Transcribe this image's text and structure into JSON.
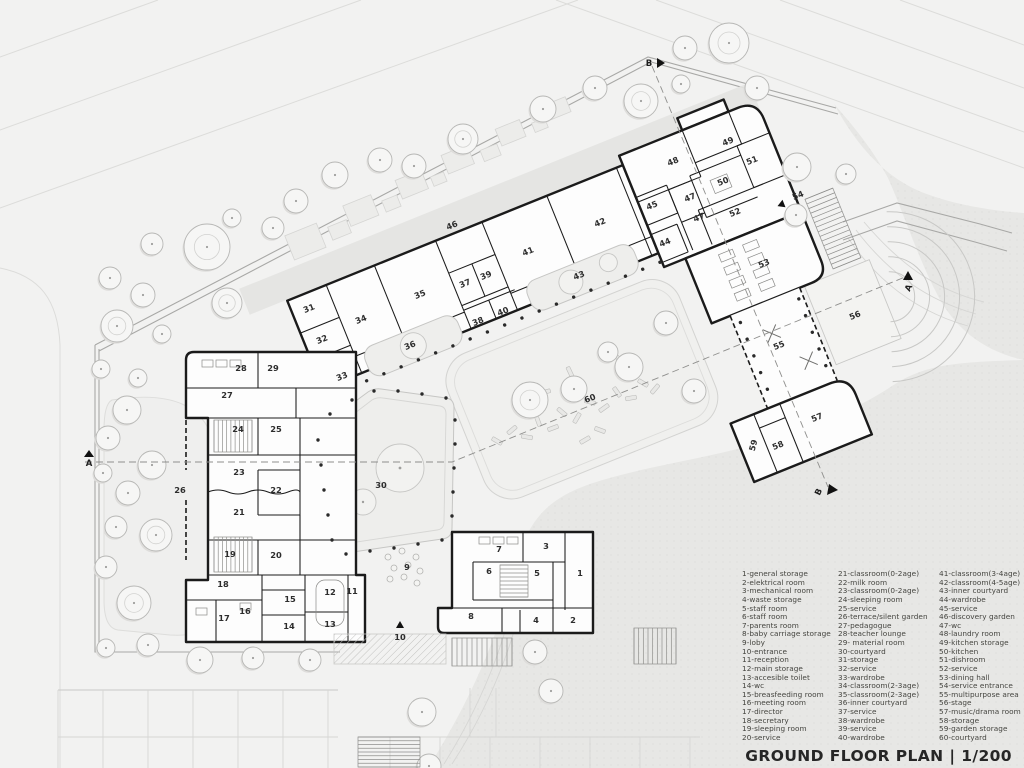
{
  "header": {
    "title": "GROUND FLOOR PLAN | 1/200"
  },
  "legend": {
    "columns": [
      [
        "1-general storage",
        "2-elektrical room",
        "3-mechanical room",
        "4-waste storage",
        "5-staff room",
        "6-staff room",
        "7-parents room",
        "8-baby carriage storage",
        "9-loby",
        "10-entrance",
        "11-reception",
        "12-main storage",
        "13-accesible toilet",
        "14-wc",
        "15-breasfeeding room",
        "16-meeting room",
        "17-director",
        "18-secretary",
        "19-sleeping room",
        "20-service"
      ],
      [
        "21-classroom(0-2age)",
        "22-milk room",
        "23-classroom(0-2age)",
        "24-sleeping room",
        "25-service",
        "26-terrace/silent garden",
        "27-pedagogue",
        "28-teacher lounge",
        "29- material room",
        "30-courtyard",
        "31-storage",
        "32-service",
        "33-wardrobe",
        "34-classroom(2-3age)",
        "35-classroom(2-3age)",
        "36-inner courtyard",
        "37-service",
        "38-wardrobe",
        "39-service",
        "40-wardrobe"
      ],
      [
        "41-classroom(3-4age)",
        "42-classroom(4-5age)",
        "43-inner courtyard",
        "44-wardrobe",
        "45-service",
        "46-discovery garden",
        "47-wc",
        "48-laundry room",
        "49-kitchen storage",
        "50-kitchen",
        "51-dishroom",
        "52-service",
        "53-dining hall",
        "54-service entrance",
        "55-multipurpose area",
        "56-stage",
        "57-music/drama room",
        "58-storage",
        "59-garden storage",
        "60-courtyard"
      ]
    ]
  },
  "plan": {
    "rooms": [
      {
        "n": "1",
        "x": 580,
        "y": 576,
        "rot": 0
      },
      {
        "n": "2",
        "x": 573,
        "y": 623,
        "rot": 0
      },
      {
        "n": "3",
        "x": 546,
        "y": 549,
        "rot": 0
      },
      {
        "n": "4",
        "x": 536,
        "y": 623,
        "rot": 0
      },
      {
        "n": "5",
        "x": 537,
        "y": 576,
        "rot": 0
      },
      {
        "n": "6",
        "x": 489,
        "y": 574,
        "rot": 0
      },
      {
        "n": "7",
        "x": 499,
        "y": 552,
        "rot": 0
      },
      {
        "n": "8",
        "x": 471,
        "y": 619,
        "rot": 0
      },
      {
        "n": "9",
        "x": 407,
        "y": 570,
        "rot": 0
      },
      {
        "n": "10",
        "x": 400,
        "y": 640,
        "rot": 0
      },
      {
        "n": "11",
        "x": 352,
        "y": 594,
        "rot": 0
      },
      {
        "n": "12",
        "x": 330,
        "y": 595,
        "rot": 0
      },
      {
        "n": "13",
        "x": 330,
        "y": 627,
        "rot": 0
      },
      {
        "n": "14",
        "x": 289,
        "y": 629,
        "rot": 0
      },
      {
        "n": "15",
        "x": 290,
        "y": 602,
        "rot": 0
      },
      {
        "n": "16",
        "x": 245,
        "y": 614,
        "rot": 0
      },
      {
        "n": "17",
        "x": 224,
        "y": 621,
        "rot": 0
      },
      {
        "n": "18",
        "x": 223,
        "y": 587,
        "rot": 0
      },
      {
        "n": "19",
        "x": 230,
        "y": 557,
        "rot": 0
      },
      {
        "n": "20",
        "x": 276,
        "y": 558,
        "rot": 0
      },
      {
        "n": "21",
        "x": 239,
        "y": 515,
        "rot": 0
      },
      {
        "n": "22",
        "x": 276,
        "y": 493,
        "rot": 0
      },
      {
        "n": "23",
        "x": 239,
        "y": 475,
        "rot": 0
      },
      {
        "n": "24",
        "x": 238,
        "y": 432,
        "rot": 0
      },
      {
        "n": "25",
        "x": 276,
        "y": 432,
        "rot": 0
      },
      {
        "n": "26",
        "x": 180,
        "y": 493,
        "rot": 0
      },
      {
        "n": "27",
        "x": 227,
        "y": 398,
        "rot": 0
      },
      {
        "n": "28",
        "x": 241,
        "y": 371,
        "rot": 0
      },
      {
        "n": "29",
        "x": 273,
        "y": 371,
        "rot": 0
      },
      {
        "n": "30",
        "x": 381,
        "y": 488,
        "rot": 0
      },
      {
        "n": "31",
        "x": 310,
        "y": 311,
        "rot": -22
      },
      {
        "n": "32",
        "x": 323,
        "y": 342,
        "rot": -22
      },
      {
        "n": "33",
        "x": 343,
        "y": 379,
        "rot": -22
      },
      {
        "n": "34",
        "x": 362,
        "y": 322,
        "rot": -22
      },
      {
        "n": "35",
        "x": 421,
        "y": 297,
        "rot": -22
      },
      {
        "n": "36",
        "x": 411,
        "y": 348,
        "rot": -22
      },
      {
        "n": "37",
        "x": 466,
        "y": 286,
        "rot": -22
      },
      {
        "n": "38",
        "x": 479,
        "y": 324,
        "rot": -22
      },
      {
        "n": "39",
        "x": 487,
        "y": 278,
        "rot": -22
      },
      {
        "n": "40",
        "x": 504,
        "y": 314,
        "rot": -22
      },
      {
        "n": "41",
        "x": 529,
        "y": 254,
        "rot": -22
      },
      {
        "n": "42",
        "x": 601,
        "y": 225,
        "rot": -22
      },
      {
        "n": "43",
        "x": 580,
        "y": 278,
        "rot": -22
      },
      {
        "n": "44",
        "x": 666,
        "y": 245,
        "rot": -22
      },
      {
        "n": "45",
        "x": 653,
        "y": 208,
        "rot": -22
      },
      {
        "n": "46",
        "x": 453,
        "y": 228,
        "rot": -22
      },
      {
        "n": "47",
        "x": 691,
        "y": 200,
        "rot": -22
      },
      {
        "n": "47",
        "x": 700,
        "y": 220,
        "rot": -22
      },
      {
        "n": "48",
        "x": 674,
        "y": 164,
        "rot": -22
      },
      {
        "n": "49",
        "x": 729,
        "y": 144,
        "rot": -22
      },
      {
        "n": "50",
        "x": 724,
        "y": 184,
        "rot": -22
      },
      {
        "n": "51",
        "x": 753,
        "y": 163,
        "rot": -22
      },
      {
        "n": "52",
        "x": 736,
        "y": 215,
        "rot": -22
      },
      {
        "n": "53",
        "x": 765,
        "y": 266,
        "rot": -22
      },
      {
        "n": "54",
        "x": 799,
        "y": 198,
        "rot": -22
      },
      {
        "n": "55",
        "x": 780,
        "y": 348,
        "rot": -22
      },
      {
        "n": "56",
        "x": 856,
        "y": 318,
        "rot": -22
      },
      {
        "n": "57",
        "x": 818,
        "y": 420,
        "rot": -22
      },
      {
        "n": "58",
        "x": 779,
        "y": 448,
        "rot": -22
      },
      {
        "n": "59",
        "x": 756,
        "y": 446,
        "rot": -75
      },
      {
        "n": "60",
        "x": 591,
        "y": 401,
        "rot": -22
      }
    ],
    "section_markers": [
      {
        "label": "A",
        "x": 89,
        "y": 466,
        "rot": 0,
        "tri": [
          89,
          450,
          84,
          457,
          94,
          457
        ]
      },
      {
        "label": "A",
        "x": 911,
        "y": 289,
        "rot": -65,
        "tri": [
          908,
          271,
          903,
          280,
          913,
          280
        ]
      },
      {
        "label": "B",
        "x": 649,
        "y": 66,
        "rot": 0,
        "tri": [
          657,
          58,
          657,
          68,
          665,
          63
        ]
      },
      {
        "label": "B",
        "x": 821,
        "y": 493,
        "rot": -65,
        "tri": [
          829,
          484,
          827,
          495,
          838,
          490
        ]
      }
    ],
    "trees": [
      [
        335,
        175,
        13
      ],
      [
        380,
        160,
        12
      ],
      [
        414,
        166,
        12
      ],
      [
        463,
        139,
        15
      ],
      [
        296,
        201,
        12
      ],
      [
        273,
        228,
        11
      ],
      [
        232,
        218,
        9
      ],
      [
        207,
        247,
        23
      ],
      [
        152,
        244,
        11
      ],
      [
        110,
        278,
        11
      ],
      [
        143,
        295,
        12
      ],
      [
        227,
        303,
        15
      ],
      [
        117,
        326,
        16
      ],
      [
        162,
        334,
        9
      ],
      [
        101,
        369,
        9
      ],
      [
        138,
        378,
        9
      ],
      [
        543,
        109,
        13
      ],
      [
        595,
        88,
        12
      ],
      [
        641,
        101,
        17
      ],
      [
        685,
        48,
        12
      ],
      [
        729,
        43,
        20
      ],
      [
        757,
        88,
        12
      ],
      [
        681,
        84,
        9
      ],
      [
        797,
        167,
        14
      ],
      [
        846,
        174,
        10
      ],
      [
        796,
        215,
        11
      ],
      [
        127,
        410,
        14
      ],
      [
        108,
        438,
        12
      ],
      [
        103,
        473,
        9
      ],
      [
        152,
        465,
        14
      ],
      [
        128,
        493,
        12
      ],
      [
        116,
        527,
        11
      ],
      [
        156,
        535,
        16
      ],
      [
        106,
        567,
        11
      ],
      [
        134,
        603,
        17
      ],
      [
        148,
        645,
        11
      ],
      [
        106,
        648,
        9
      ],
      [
        200,
        660,
        13
      ],
      [
        253,
        658,
        11
      ],
      [
        310,
        660,
        11
      ],
      [
        422,
        712,
        14
      ],
      [
        535,
        652,
        12
      ],
      [
        551,
        691,
        12
      ],
      [
        429,
        766,
        12
      ],
      [
        530,
        400,
        18
      ],
      [
        694,
        391,
        12
      ],
      [
        629,
        367,
        14
      ],
      [
        666,
        323,
        12
      ],
      [
        574,
        389,
        13
      ],
      [
        608,
        352,
        10
      ]
    ],
    "logs": [
      [
        497,
        441,
        30
      ],
      [
        512,
        430,
        -40
      ],
      [
        527,
        437,
        10
      ],
      [
        538,
        421,
        70
      ],
      [
        553,
        428,
        -20
      ],
      [
        562,
        412,
        40
      ],
      [
        577,
        418,
        -60
      ],
      [
        590,
        402,
        15
      ],
      [
        604,
        408,
        -35
      ],
      [
        617,
        392,
        55
      ],
      [
        631,
        398,
        -10
      ],
      [
        643,
        383,
        30
      ],
      [
        655,
        389,
        -50
      ],
      [
        600,
        430,
        20
      ],
      [
        585,
        440,
        -30
      ],
      [
        570,
        372,
        65
      ],
      [
        545,
        392,
        -15
      ],
      [
        620,
        360,
        45
      ]
    ],
    "beds_local": [
      [
        347,
        244,
        34,
        26
      ],
      [
        390,
        252,
        20,
        14
      ],
      [
        412,
        238,
        30,
        22
      ],
      [
        450,
        248,
        16,
        12
      ],
      [
        470,
        234,
        28,
        20
      ],
      [
        504,
        244,
        14,
        10
      ],
      [
        522,
        228,
        28,
        20
      ],
      [
        560,
        238,
        18,
        12
      ],
      [
        582,
        224,
        26,
        18
      ],
      [
        618,
        232,
        14,
        10
      ],
      [
        637,
        220,
        22,
        16
      ]
    ],
    "dots9": [
      [
        388,
        557
      ],
      [
        402,
        551
      ],
      [
        416,
        557
      ],
      [
        394,
        568
      ],
      [
        408,
        565
      ],
      [
        420,
        571
      ],
      [
        390,
        579
      ],
      [
        404,
        577
      ],
      [
        417,
        583
      ]
    ],
    "colonnade_local": [
      {
        "from": [
          350,
          409
        ],
        "to": [
          685,
          409
        ],
        "n": 19
      },
      {
        "from": [
          737,
          495
        ],
        "to": [
          737,
          567
        ],
        "n": 5
      },
      {
        "from": [
          800,
          495
        ],
        "to": [
          800,
          567
        ],
        "n": 5
      }
    ],
    "colonnade_screen": [
      [
        330,
        414
      ],
      [
        352,
        400
      ],
      [
        374,
        391
      ],
      [
        398,
        391
      ],
      [
        422,
        394
      ],
      [
        446,
        398
      ],
      [
        455,
        420
      ],
      [
        455,
        444
      ],
      [
        454,
        468
      ],
      [
        453,
        492
      ],
      [
        452,
        516
      ],
      [
        442,
        540
      ],
      [
        418,
        544
      ],
      [
        394,
        548
      ],
      [
        370,
        551
      ],
      [
        346,
        554
      ],
      [
        332,
        540
      ],
      [
        328,
        515
      ],
      [
        324,
        490
      ],
      [
        321,
        465
      ],
      [
        318,
        440
      ]
    ],
    "stairs": [
      {
        "space": "local",
        "x": 843,
        "y": 405,
        "w": 30,
        "h": 75,
        "dir": "h",
        "n": 15
      },
      {
        "space": "screen",
        "x": 452,
        "y": 638,
        "w": 60,
        "h": 28,
        "dir": "v",
        "n": 12
      },
      {
        "space": "screen",
        "x": 358,
        "y": 737,
        "w": 62,
        "h": 30,
        "dir": "h",
        "n": 8
      },
      {
        "space": "screen",
        "x": 634,
        "y": 628,
        "w": 42,
        "h": 36,
        "dir": "v",
        "n": 9
      },
      {
        "space": "screen",
        "x": 500,
        "y": 565,
        "w": 28,
        "h": 32,
        "dir": "h",
        "n": 8
      },
      {
        "space": "screen",
        "x": 214,
        "y": 420,
        "w": 38,
        "h": 32,
        "dir": "v",
        "n": 9
      },
      {
        "space": "screen",
        "x": 214,
        "y": 537,
        "w": 38,
        "h": 35,
        "dir": "v",
        "n": 9
      }
    ],
    "tables_local": [
      [
        742,
        424
      ],
      [
        742,
        438
      ],
      [
        742,
        452
      ],
      [
        742,
        466
      ],
      [
        768,
        424
      ],
      [
        768,
        438
      ],
      [
        768,
        452
      ],
      [
        768,
        466
      ]
    ],
    "tables_screen": [
      [
        479,
        537
      ],
      [
        493,
        537
      ],
      [
        507,
        537
      ],
      [
        202,
        360
      ],
      [
        216,
        360
      ],
      [
        230,
        360
      ],
      [
        240,
        603
      ],
      [
        196,
        608
      ]
    ],
    "xmarks_local": [
      [
        762,
        517
      ],
      [
        786,
        556
      ]
    ]
  },
  "colors": {
    "paper": "#f2f2f1",
    "terrain": "#e7e7e5",
    "wall": "#1b1b1b",
    "building": "#fdfdfd",
    "courtyard": "#eeeeec",
    "path_band": "#e3e3e1",
    "tree_stroke": "#b7b7b5",
    "dash": "#8f8f8d"
  }
}
